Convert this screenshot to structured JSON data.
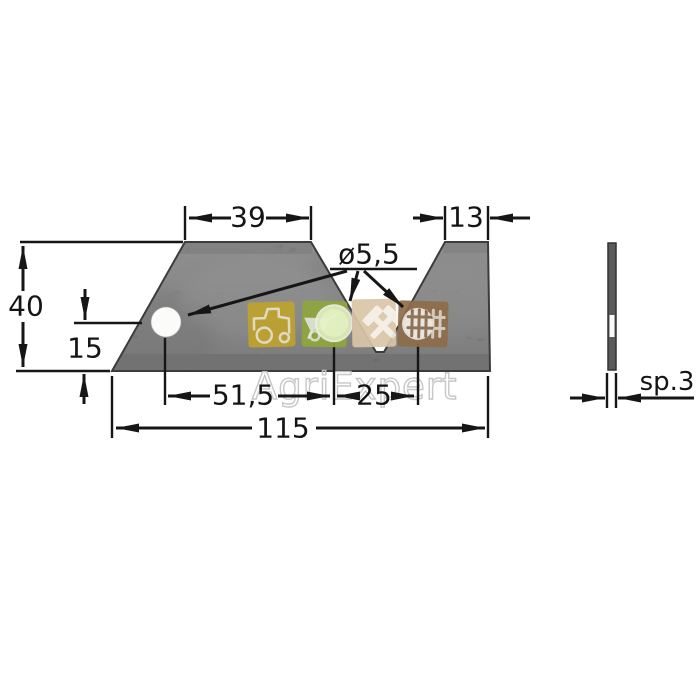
{
  "dimensions": {
    "top_width_left": "39",
    "top_width_right": "13",
    "total_height": "40",
    "hole_height_from_bottom": "15",
    "hole_spacing_left": "51,5",
    "hole_spacing_right": "25",
    "total_width": "115",
    "hole_diameter": "ø5,5",
    "thickness": "sp.3"
  },
  "watermark": {
    "text": "AgriExpert",
    "icons": [
      {
        "name": "tractor-icon",
        "color": "#bfa32d"
      },
      {
        "name": "wheelbarrow-icon",
        "color": "#8fa73c"
      },
      {
        "name": "hammer-wrench-icon",
        "color": "#dbc6a8"
      },
      {
        "name": "fence-icon",
        "color": "#8e6d4b"
      }
    ]
  },
  "colors": {
    "background": "#ffffff",
    "line": "#161616",
    "blade_body": "#5e5e5e",
    "blade_bottom_band": "#353535",
    "blade_outline": "#3c3c3c",
    "hole_fill": "#fbfbfa",
    "watermark_stroke": "#c5c5c5",
    "wheelbarrow_hole_highlight": "#e6f3c4",
    "fence_hole_highlight": "#efebe4"
  }
}
